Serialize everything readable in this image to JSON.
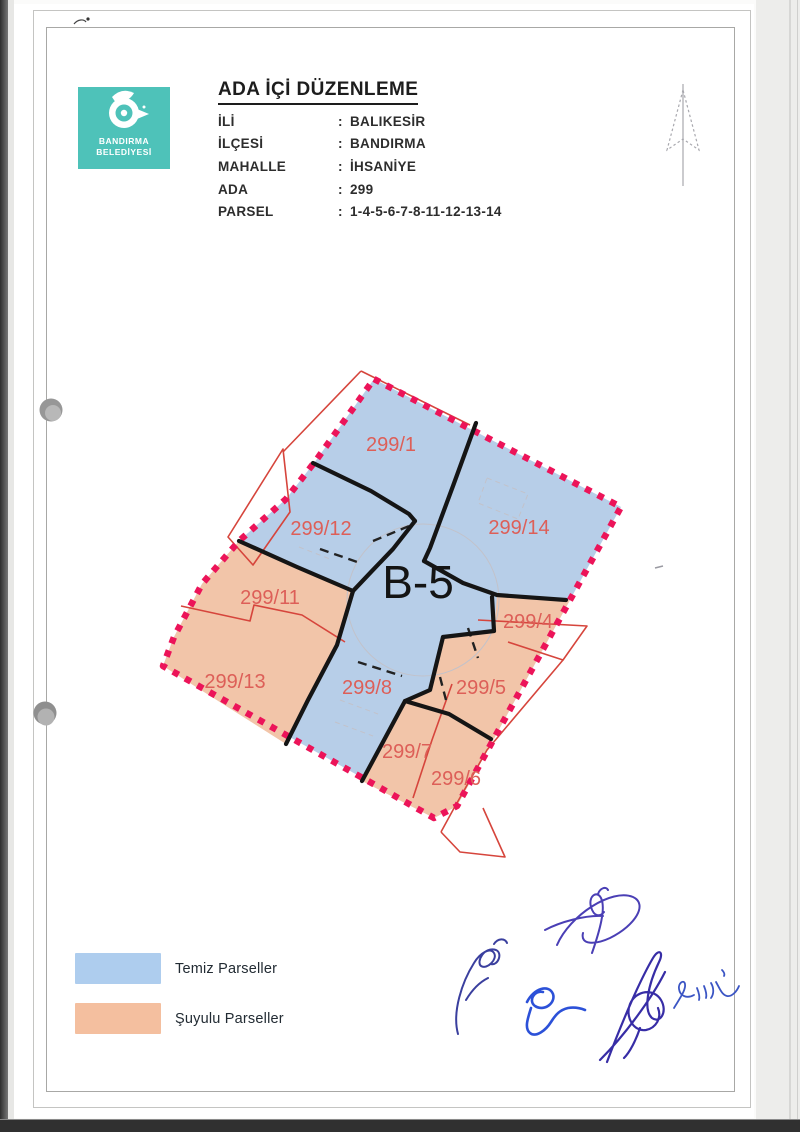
{
  "header": {
    "logo": {
      "line1": "BANDIRMA",
      "line2": "BELEDİYESİ"
    },
    "title": "ADA İÇİ DÜZENLEME",
    "colon": ":",
    "fields": [
      {
        "label": "İLİ",
        "value": "BALIKESİR"
      },
      {
        "label": "İLÇESİ",
        "value": "BANDIRMA"
      },
      {
        "label": "MAHALLE",
        "value": "İHSANİYE"
      },
      {
        "label": "ADA",
        "value": "299"
      },
      {
        "label": "PARSEL",
        "value": "1-4-5-6-7-8-11-12-13-14"
      }
    ]
  },
  "map": {
    "block_label": "B-5",
    "parcels": [
      {
        "id": "299/1",
        "type": "temiz"
      },
      {
        "id": "299/12",
        "type": "temiz"
      },
      {
        "id": "299/14",
        "type": "temiz"
      },
      {
        "id": "299/11",
        "type": "suyulu"
      },
      {
        "id": "299/4",
        "type": "suyulu"
      },
      {
        "id": "299/13",
        "type": "suyulu"
      },
      {
        "id": "299/8",
        "type": "temiz"
      },
      {
        "id": "299/5",
        "type": "suyulu"
      },
      {
        "id": "299/7",
        "type": "suyulu"
      },
      {
        "id": "299/6",
        "type": "suyulu"
      }
    ]
  },
  "legend": {
    "items": [
      {
        "label": "Temiz Parseller",
        "color": "#aecdee",
        "type": "temiz"
      },
      {
        "label": "Şuyulu Parseller",
        "color": "#f4bf9f",
        "type": "suyulu"
      }
    ]
  },
  "colors": {
    "boundary_dashed": "#ec1459",
    "temiz_fill": "#b7cee8",
    "suyulu_fill": "#f2c5a9",
    "parcel_label": "#dd5f58",
    "logo_teal": "#4ec2b9"
  }
}
